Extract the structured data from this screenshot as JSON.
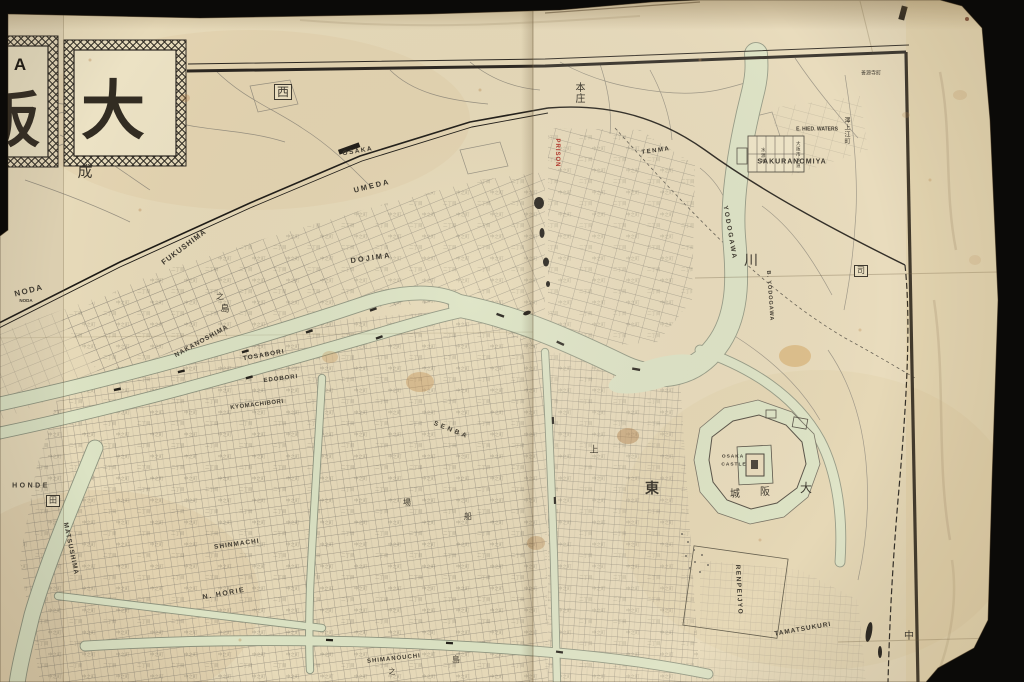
{
  "scene": {
    "background": "#0b0a08",
    "paper": "#e7dab9",
    "frame": "#2b2620",
    "river": "#dce3c4",
    "accent_red": "#b03a2e"
  },
  "title_block": {
    "char_main": "大",
    "char_left_partial": "阪",
    "latin_partial": "A"
  },
  "map": {
    "noise_a": "二丁目",
    "noise_b": "中之町",
    "labels": [
      {
        "t": "OSAKA",
        "x": 358,
        "y": 152,
        "r": -10,
        "s": 6.5,
        "cls": "en",
        "sp": 1.5
      },
      {
        "t": "UMEDA",
        "x": 372,
        "y": 186,
        "r": -14,
        "s": 7.5,
        "cls": "en",
        "sp": 2
      },
      {
        "t": "NODA",
        "x": 29,
        "y": 291,
        "r": -14,
        "s": 8,
        "cls": "en",
        "sp": 1.5
      },
      {
        "t": "NODA",
        "x": 26,
        "y": 301,
        "r": 0,
        "s": 4.5,
        "cls": "en"
      },
      {
        "t": "FUKUSHIMA",
        "x": 184,
        "y": 247,
        "r": -37,
        "s": 7.5,
        "cls": "en",
        "sp": 1
      },
      {
        "t": "DOJIMA",
        "x": 371,
        "y": 258,
        "r": -8,
        "s": 7.5,
        "cls": "en",
        "sp": 2
      },
      {
        "t": "NAKANOSHIMA",
        "x": 202,
        "y": 342,
        "r": -29,
        "s": 6.5,
        "cls": "en",
        "sp": 1
      },
      {
        "t": "TOSABORI",
        "x": 264,
        "y": 356,
        "r": -10,
        "s": 6.5,
        "cls": "en",
        "sp": 1
      },
      {
        "t": "EDOBORI",
        "x": 281,
        "y": 379,
        "r": -7,
        "s": 6,
        "cls": "en",
        "sp": 1
      },
      {
        "t": "KYOMACHIBORI",
        "x": 257,
        "y": 405,
        "r": -7,
        "s": 6,
        "cls": "en",
        "sp": 0.5
      },
      {
        "t": "SHINMACHI",
        "x": 237,
        "y": 545,
        "r": -8,
        "s": 6.5,
        "cls": "en",
        "sp": 1
      },
      {
        "t": "N. HORIE",
        "x": 224,
        "y": 594,
        "r": -10,
        "s": 7,
        "cls": "en",
        "sp": 1.5
      },
      {
        "t": "MATSUSHIMA",
        "x": 70,
        "y": 549,
        "r": 78,
        "s": 6.5,
        "cls": "en",
        "sp": 1
      },
      {
        "t": "HONDE",
        "x": 31,
        "y": 486,
        "r": 0,
        "s": 7,
        "cls": "en",
        "sp": 2.5
      },
      {
        "t": "SHIMANOUCHI",
        "x": 394,
        "y": 659,
        "r": -6,
        "s": 6,
        "cls": "en",
        "sp": 1
      },
      {
        "t": "SENBA",
        "x": 451,
        "y": 431,
        "r": 22,
        "s": 6.5,
        "cls": "en",
        "sp": 3
      },
      {
        "t": "TENMA",
        "x": 656,
        "y": 151,
        "r": -8,
        "s": 6,
        "cls": "en",
        "sp": 1.5
      },
      {
        "t": "SAKURANOMIYA",
        "x": 792,
        "y": 162,
        "r": 0,
        "s": 7,
        "cls": "en",
        "sp": 1
      },
      {
        "t": "E. HIED. WATERS",
        "x": 817,
        "y": 130,
        "r": 0,
        "s": 5,
        "cls": "en"
      },
      {
        "t": "YODOGAWA",
        "x": 729,
        "y": 233,
        "r": 80,
        "s": 6.5,
        "cls": "en",
        "sp": 2
      },
      {
        "t": "B. YODOGAWA",
        "x": 769,
        "y": 296,
        "r": 86,
        "s": 5.5,
        "cls": "en",
        "sp": 1
      },
      {
        "t": "OSAKA",
        "x": 733,
        "y": 458,
        "r": 0,
        "s": 4.8,
        "cls": "en",
        "sp": 1
      },
      {
        "t": "CASTLE",
        "x": 734,
        "y": 466,
        "r": 0,
        "s": 4.8,
        "cls": "en",
        "sp": 1
      },
      {
        "t": "RENPEIJYO",
        "x": 738,
        "y": 590,
        "r": 87,
        "s": 6.5,
        "cls": "en",
        "sp": 1.5
      },
      {
        "t": "TAMATSUKURI",
        "x": 803,
        "y": 630,
        "r": -10,
        "s": 6.5,
        "cls": "en",
        "sp": 1
      },
      {
        "t": "PRISON",
        "x": 557,
        "y": 153,
        "r": 90,
        "s": 6,
        "cls": "en",
        "c": "#b03a2e",
        "sp": 1
      },
      {
        "t": "西",
        "x": 283,
        "y": 92,
        "r": 0,
        "s": 12,
        "cls": "kj",
        "b": true
      },
      {
        "t": "成",
        "x": 85,
        "y": 172,
        "r": 0,
        "s": 15,
        "cls": "kj"
      },
      {
        "t": "本庄",
        "x": 578,
        "y": 93,
        "r": 0,
        "s": 10,
        "cls": "kj",
        "v": true
      },
      {
        "t": "川",
        "x": 751,
        "y": 261,
        "r": 0,
        "s": 14,
        "cls": "kj"
      },
      {
        "t": "澤上江町",
        "x": 846,
        "y": 131,
        "r": 0,
        "s": 6,
        "cls": "kj",
        "v": true
      },
      {
        "t": "善源寺町",
        "x": 871,
        "y": 74,
        "r": 0,
        "s": 5,
        "cls": "kj"
      },
      {
        "t": "東",
        "x": 652,
        "y": 489,
        "r": 0,
        "s": 14,
        "cls": "kj",
        "w": true
      },
      {
        "t": "大",
        "x": 806,
        "y": 488,
        "r": 0,
        "s": 12,
        "cls": "kj"
      },
      {
        "t": "阪",
        "x": 765,
        "y": 493,
        "r": 0,
        "s": 10,
        "cls": "kj"
      },
      {
        "t": "城",
        "x": 735,
        "y": 495,
        "r": 0,
        "s": 10,
        "cls": "kj"
      },
      {
        "t": "中",
        "x": 909,
        "y": 637,
        "r": 0,
        "s": 10,
        "cls": "kj"
      },
      {
        "t": "司",
        "x": 861,
        "y": 271,
        "r": 0,
        "s": 8,
        "cls": "kj",
        "b": true
      },
      {
        "t": "田",
        "x": 53,
        "y": 501,
        "r": 0,
        "s": 8,
        "cls": "kj",
        "b": true
      },
      {
        "t": "島",
        "x": 456,
        "y": 660,
        "r": 0,
        "s": 8,
        "cls": "kj"
      },
      {
        "t": "之",
        "x": 392,
        "y": 672,
        "r": 0,
        "s": 7,
        "cls": "kj"
      },
      {
        "t": "上",
        "x": 594,
        "y": 451,
        "r": 0,
        "s": 9,
        "cls": "kj"
      },
      {
        "t": "之",
        "x": 220,
        "y": 297,
        "r": 0,
        "s": 8,
        "cls": "kj"
      },
      {
        "t": "島",
        "x": 225,
        "y": 310,
        "r": 0,
        "s": 9,
        "cls": "kj"
      },
      {
        "t": "場",
        "x": 407,
        "y": 503,
        "r": 0,
        "s": 8,
        "cls": "kj"
      },
      {
        "t": "船",
        "x": 468,
        "y": 517,
        "r": 0,
        "s": 8,
        "cls": "kj"
      },
      {
        "t": "水源地",
        "x": 762,
        "y": 156,
        "r": 0,
        "s": 4.5,
        "cls": "kj",
        "v": true
      },
      {
        "t": "大阪市水道",
        "x": 797,
        "y": 155,
        "r": 0,
        "s": 4.5,
        "cls": "kj",
        "v": true
      }
    ]
  }
}
